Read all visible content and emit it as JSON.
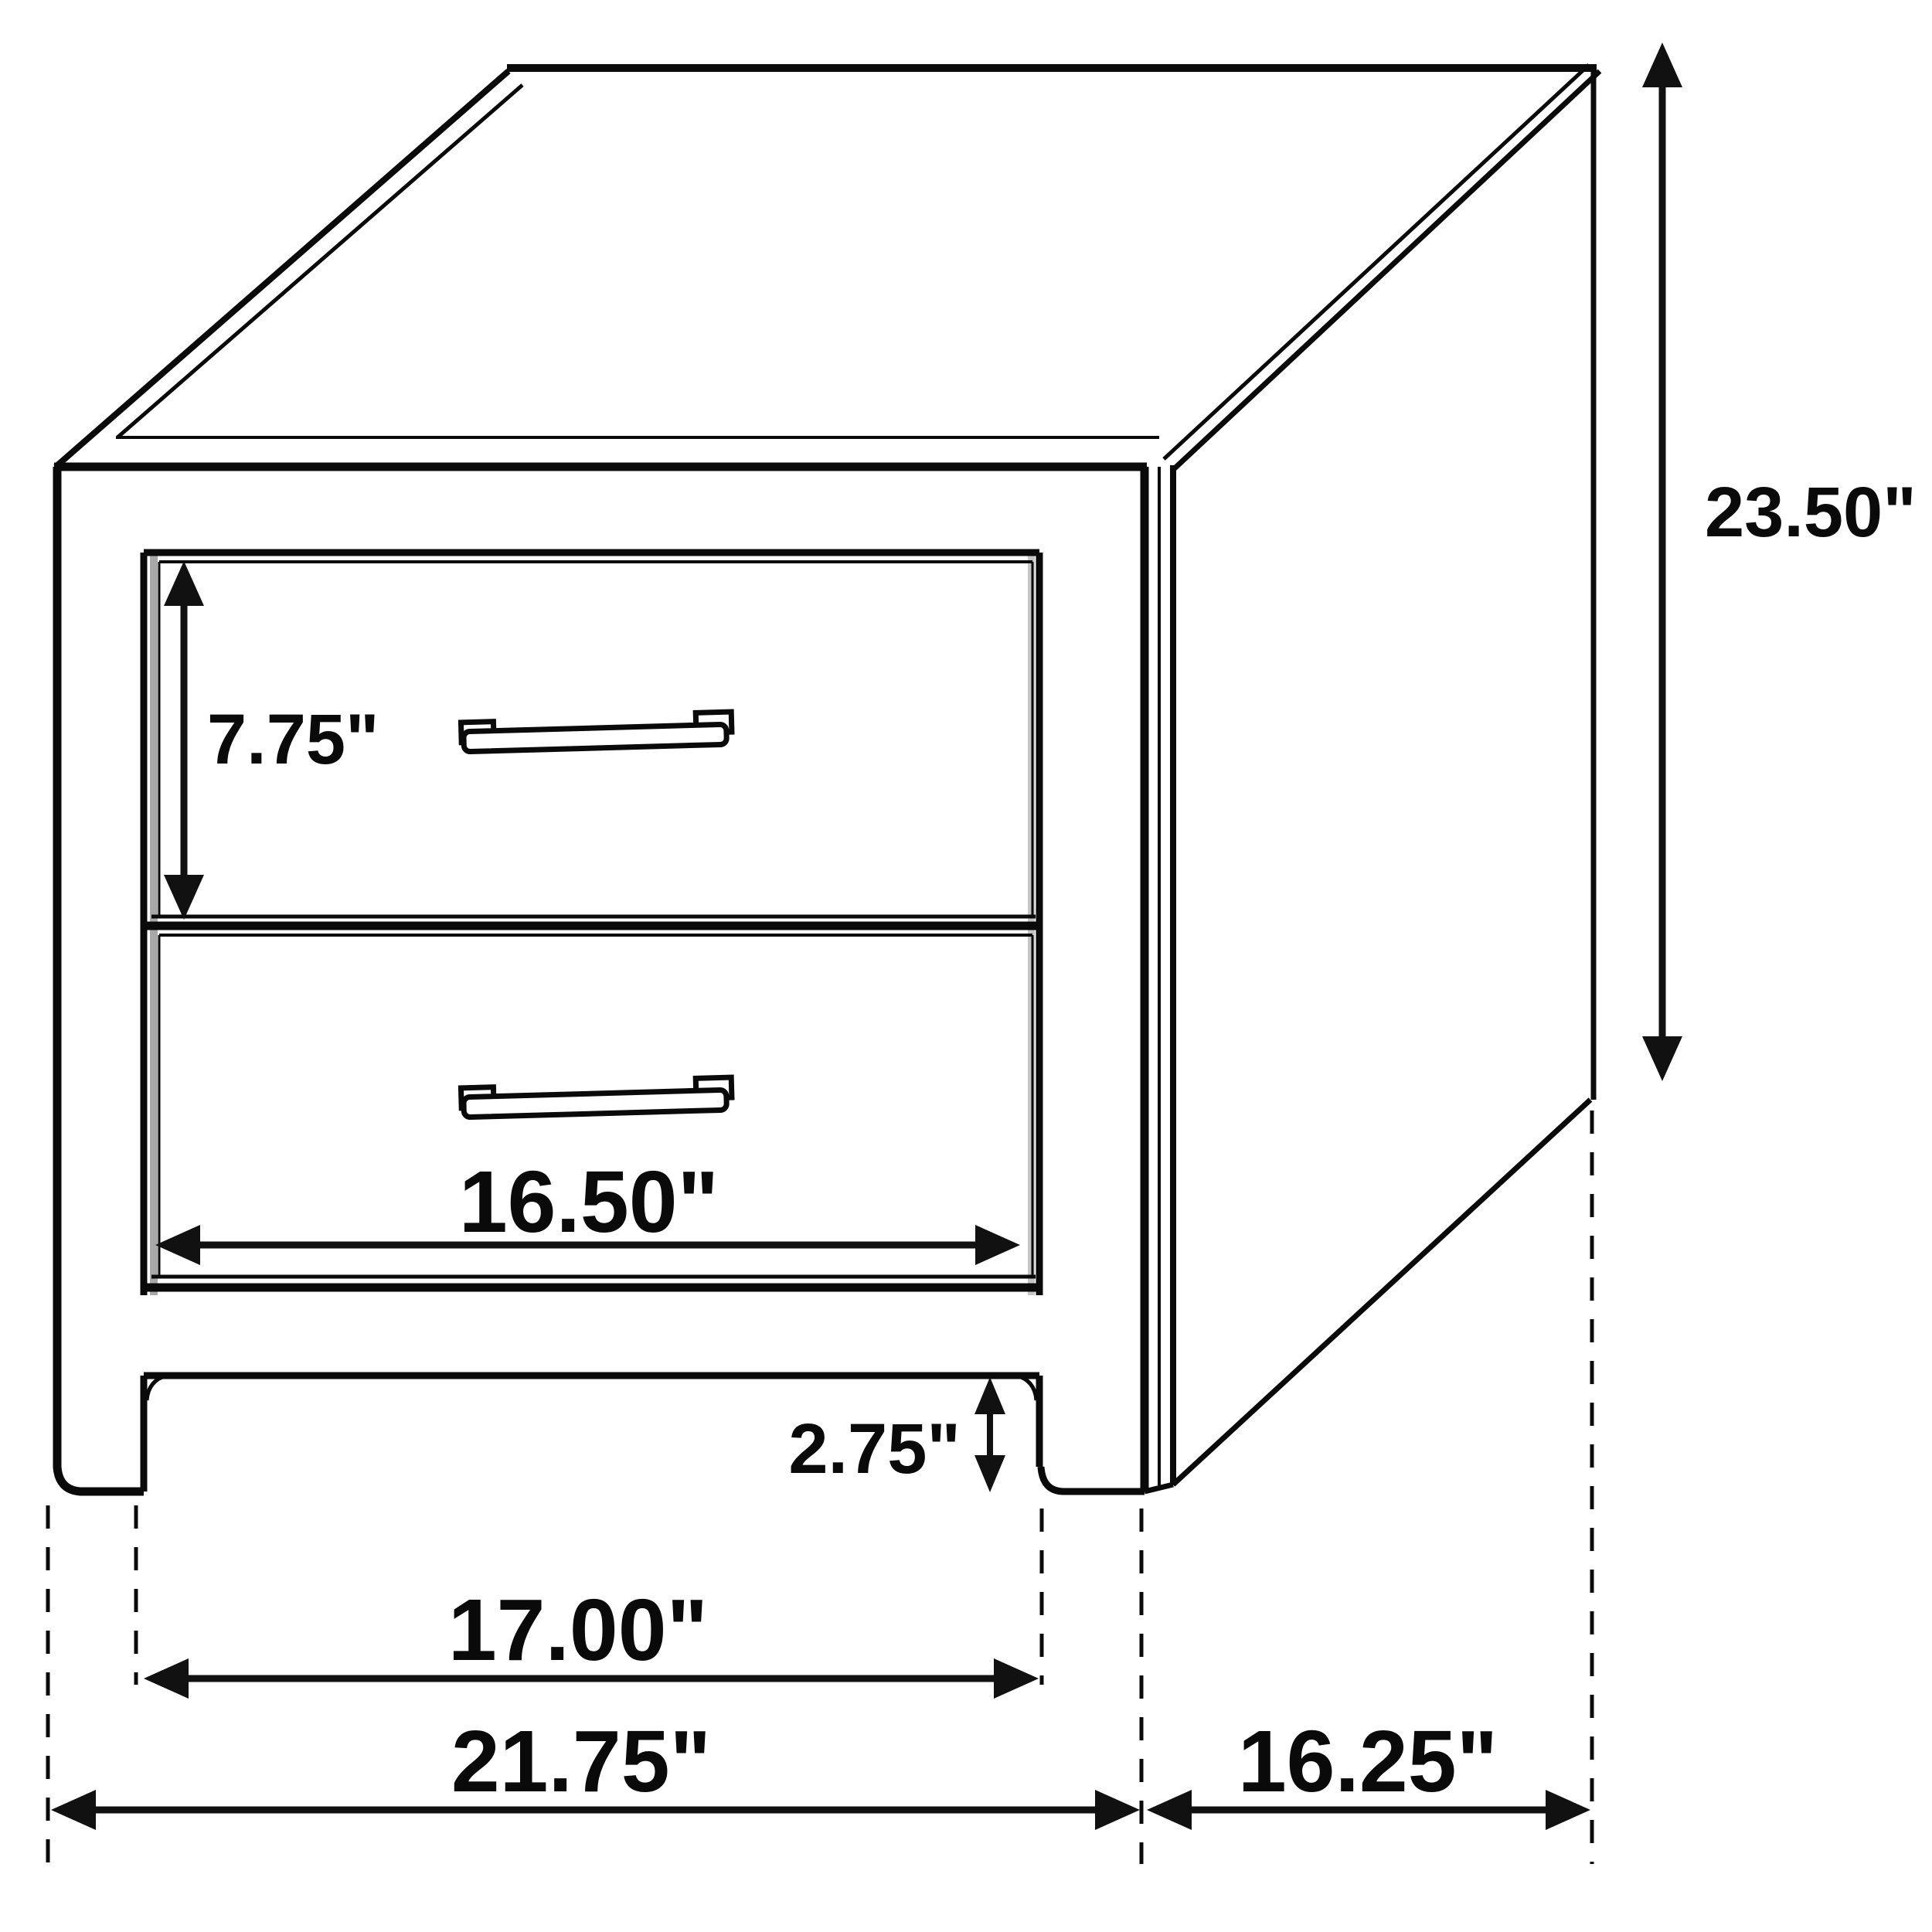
{
  "diagram": {
    "background_color": "#ffffff",
    "line_color": "#0a0a0a",
    "shading_color": "#a8a8a8",
    "labels": {
      "overall_height": "23.50\"",
      "drawer_height": "7.75\"",
      "drawer_width": "16.50\"",
      "foot_height": "2.75\"",
      "inner_width": "17.00\"",
      "overall_width": "21.75\"",
      "depth": "16.25\""
    }
  }
}
